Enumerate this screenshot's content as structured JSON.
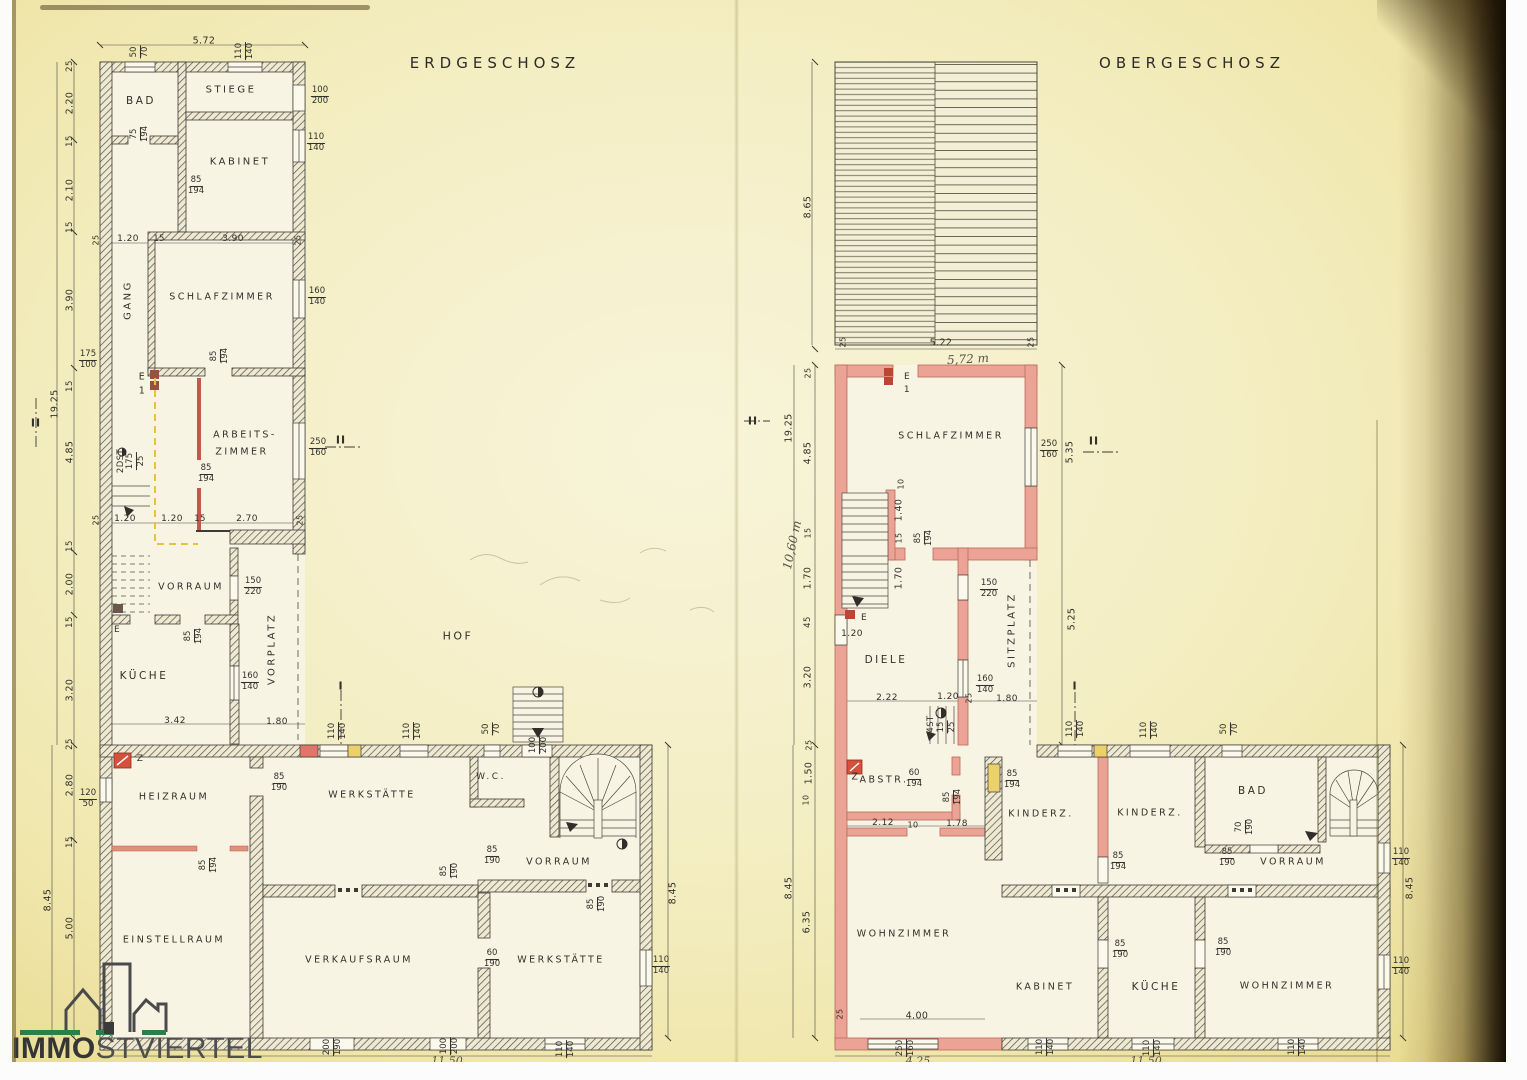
{
  "logo": {
    "bold": "IMMO",
    "light": "STVIERTEL"
  },
  "floors": {
    "left_title": "ERDGESCHOSZ",
    "right_title": "OBERGESCHOSZ"
  },
  "labels": [
    {
      "k": "title",
      "t": "ERDGESCHOSZ",
      "x": 495,
      "y": 63
    },
    {
      "k": "title",
      "t": "OBERGESCHOSZ",
      "x": 1192,
      "y": 63
    },
    {
      "k": "frac",
      "t": "50/70",
      "x": 140,
      "y": 52,
      "r": -90
    },
    {
      "k": "dim",
      "t": "5.72",
      "x": 204,
      "y": 41
    },
    {
      "k": "frac",
      "t": "110/140",
      "x": 245,
      "y": 51,
      "r": -90
    },
    {
      "k": "dim",
      "t": "25",
      "x": 70,
      "y": 66,
      "r": -90,
      "s": 8.5
    },
    {
      "k": "dim",
      "t": "2.20",
      "x": 70,
      "y": 103,
      "r": -90
    },
    {
      "k": "dim",
      "t": "15",
      "x": 70,
      "y": 141,
      "r": -90,
      "s": 8.5
    },
    {
      "k": "dim",
      "t": "2.10",
      "x": 70,
      "y": 190,
      "r": -90
    },
    {
      "k": "dim",
      "t": "15",
      "x": 70,
      "y": 227,
      "r": -90,
      "s": 8.5
    },
    {
      "k": "dim",
      "t": "3.90",
      "x": 70,
      "y": 300,
      "r": -90
    },
    {
      "k": "frac",
      "t": "175/100",
      "x": 88,
      "y": 360
    },
    {
      "k": "dim",
      "t": "15",
      "x": 70,
      "y": 386,
      "r": -90,
      "s": 8.5
    },
    {
      "k": "dim",
      "t": "19.25",
      "x": 55,
      "y": 404,
      "r": -90
    },
    {
      "k": "mark",
      "t": "II",
      "x": 36,
      "y": 423
    },
    {
      "k": "dim",
      "t": "4.85",
      "x": 70,
      "y": 452,
      "r": -90
    },
    {
      "k": "dim",
      "t": "15",
      "x": 70,
      "y": 546,
      "r": -90,
      "s": 8.5
    },
    {
      "k": "dim",
      "t": "2.00",
      "x": 70,
      "y": 584,
      "r": -90
    },
    {
      "k": "dim",
      "t": "15",
      "x": 70,
      "y": 622,
      "r": -90,
      "s": 8.5
    },
    {
      "k": "dim",
      "t": "3.20",
      "x": 70,
      "y": 690,
      "r": -90
    },
    {
      "k": "dim",
      "t": "25",
      "x": 70,
      "y": 744,
      "r": -90,
      "s": 8.5
    },
    {
      "k": "dim",
      "t": "2.80",
      "x": 70,
      "y": 785,
      "r": -90
    },
    {
      "k": "frac",
      "t": "120/50",
      "x": 88,
      "y": 799
    },
    {
      "k": "dim",
      "t": "15",
      "x": 70,
      "y": 842,
      "r": -90,
      "s": 8.5
    },
    {
      "k": "dim",
      "t": "8.45",
      "x": 48,
      "y": 900,
      "r": -90
    },
    {
      "k": "dim",
      "t": "5.00",
      "x": 70,
      "y": 928,
      "r": -90
    },
    {
      "k": "room",
      "t": "BAD",
      "x": 141,
      "y": 101,
      "s": 10.5
    },
    {
      "k": "room",
      "t": "STIEGE",
      "x": 231,
      "y": 90,
      "s": 10
    },
    {
      "k": "frac",
      "t": "100/200",
      "x": 320,
      "y": 96
    },
    {
      "k": "room",
      "t": "KABINET",
      "x": 240,
      "y": 162,
      "s": 10
    },
    {
      "k": "frac",
      "t": "110/140",
      "x": 316,
      "y": 143
    },
    {
      "k": "frac",
      "t": "75/194",
      "x": 140,
      "y": 134,
      "r": -90
    },
    {
      "k": "frac",
      "t": "85/194",
      "x": 196,
      "y": 186
    },
    {
      "k": "dim",
      "t": "25",
      "x": 96,
      "y": 240,
      "r": -90,
      "s": 8
    },
    {
      "k": "dim",
      "t": "1.20",
      "x": 128,
      "y": 239,
      "s": 9
    },
    {
      "k": "dim",
      "t": "15",
      "x": 159,
      "y": 239,
      "s": 8.5
    },
    {
      "k": "dim",
      "t": "3.90",
      "x": 233,
      "y": 239,
      "s": 9
    },
    {
      "k": "dim",
      "t": "25",
      "x": 298,
      "y": 240,
      "r": -90,
      "s": 8
    },
    {
      "k": "room",
      "t": "GANG",
      "x": 128,
      "y": 300,
      "r": -90,
      "s": 10
    },
    {
      "k": "room",
      "t": "SCHLAFZIMMER",
      "x": 222,
      "y": 297,
      "s": 9.5
    },
    {
      "k": "frac",
      "t": "160/140",
      "x": 317,
      "y": 297
    },
    {
      "k": "frac",
      "t": "85/194",
      "x": 220,
      "y": 356,
      "r": -90
    },
    {
      "k": "dim",
      "t": "E",
      "x": 142,
      "y": 377,
      "s": 9.5
    },
    {
      "k": "dim",
      "t": "1",
      "x": 142,
      "y": 391,
      "s": 9.5
    },
    {
      "k": "dim",
      "t": "2DST",
      "x": 121,
      "y": 461,
      "r": -90,
      "s": 8.5
    },
    {
      "k": "frac",
      "t": "175/25",
      "x": 136,
      "y": 461,
      "r": -90
    },
    {
      "k": "room",
      "t": "ARBEITS-",
      "x": 245,
      "y": 435,
      "s": 9.5
    },
    {
      "k": "room",
      "t": "ZIMMER",
      "x": 242,
      "y": 452,
      "s": 9.5
    },
    {
      "k": "frac",
      "t": "250/160",
      "x": 318,
      "y": 448
    },
    {
      "k": "mark",
      "t": "II",
      "x": 341,
      "y": 440
    },
    {
      "k": "frac",
      "t": "85/194",
      "x": 206,
      "y": 474
    },
    {
      "k": "dim",
      "t": "25",
      "x": 96,
      "y": 520,
      "r": -90,
      "s": 8
    },
    {
      "k": "dim",
      "t": "1.20",
      "x": 125,
      "y": 519,
      "s": 9
    },
    {
      "k": "dim",
      "t": "1.20",
      "x": 172,
      "y": 519,
      "s": 9
    },
    {
      "k": "dim",
      "t": "15",
      "x": 200,
      "y": 519,
      "s": 8.5
    },
    {
      "k": "dim",
      "t": "2.70",
      "x": 247,
      "y": 519,
      "s": 9
    },
    {
      "k": "dim",
      "t": "25",
      "x": 300,
      "y": 520,
      "r": -90,
      "s": 8
    },
    {
      "k": "room",
      "t": "VORRAUM",
      "x": 191,
      "y": 587,
      "s": 9.5
    },
    {
      "k": "frac",
      "t": "150/220",
      "x": 253,
      "y": 587
    },
    {
      "k": "dim",
      "t": "E",
      "x": 117,
      "y": 630,
      "s": 9
    },
    {
      "k": "frac",
      "t": "85/194",
      "x": 194,
      "y": 636,
      "r": -90
    },
    {
      "k": "room",
      "t": "KÜCHE",
      "x": 144,
      "y": 676,
      "s": 10.5
    },
    {
      "k": "room",
      "t": "VORPLATZ",
      "x": 272,
      "y": 649,
      "r": -90,
      "s": 10
    },
    {
      "k": "frac",
      "t": "160/140",
      "x": 250,
      "y": 682
    },
    {
      "k": "dim",
      "t": "3.42",
      "x": 175,
      "y": 721,
      "s": 9
    },
    {
      "k": "dim",
      "t": "1.80",
      "x": 277,
      "y": 722,
      "s": 9
    },
    {
      "k": "room",
      "t": "HOF",
      "x": 458,
      "y": 636,
      "s": 11
    },
    {
      "k": "mark",
      "t": "I",
      "x": 341,
      "y": 686
    },
    {
      "k": "frac",
      "t": "110/140",
      "x": 338,
      "y": 731,
      "r": -90
    },
    {
      "k": "frac",
      "t": "110/140",
      "x": 413,
      "y": 731,
      "r": -90
    },
    {
      "k": "frac",
      "t": "50/70",
      "x": 492,
      "y": 729,
      "r": -90
    },
    {
      "k": "frac",
      "t": "100/200",
      "x": 539,
      "y": 745,
      "r": -90
    },
    {
      "k": "dim",
      "t": "Z",
      "x": 140,
      "y": 759,
      "s": 9
    },
    {
      "k": "room",
      "t": "HEIZRAUM",
      "x": 174,
      "y": 797,
      "s": 9.5
    },
    {
      "k": "frac",
      "t": "85/190",
      "x": 279,
      "y": 783
    },
    {
      "k": "room",
      "t": "WERKSTÄTTE",
      "x": 372,
      "y": 795,
      "s": 9.5
    },
    {
      "k": "frac",
      "t": "85/194",
      "x": 209,
      "y": 865,
      "r": -90
    },
    {
      "k": "room",
      "t": "W.C.",
      "x": 491,
      "y": 777,
      "s": 9
    },
    {
      "k": "frac",
      "t": "85/190",
      "x": 492,
      "y": 856
    },
    {
      "k": "frac",
      "t": "85/190",
      "x": 450,
      "y": 871,
      "r": -90
    },
    {
      "k": "room",
      "t": "VORRAUM",
      "x": 559,
      "y": 862,
      "s": 9.5
    },
    {
      "k": "frac",
      "t": "85/190",
      "x": 597,
      "y": 904,
      "r": -90
    },
    {
      "k": "room",
      "t": "EINSTELLRAUM",
      "x": 174,
      "y": 940,
      "s": 9.5
    },
    {
      "k": "room",
      "t": "VERKAUFSRAUM",
      "x": 359,
      "y": 960,
      "s": 9.5
    },
    {
      "k": "frac",
      "t": "60/190",
      "x": 492,
      "y": 959
    },
    {
      "k": "room",
      "t": "WERKSTÄTTE",
      "x": 561,
      "y": 960,
      "s": 9.5
    },
    {
      "k": "frac",
      "t": "110/140",
      "x": 661,
      "y": 966
    },
    {
      "k": "dim",
      "t": "8.45",
      "x": 673,
      "y": 893,
      "r": -90
    },
    {
      "k": "frac",
      "t": "200/190",
      "x": 333,
      "y": 1047,
      "r": -90
    },
    {
      "k": "frac",
      "t": "100/200",
      "x": 450,
      "y": 1046,
      "r": -90
    },
    {
      "k": "hand",
      "t": "11,50",
      "x": 447,
      "y": 1061,
      "s": 11
    },
    {
      "k": "frac",
      "t": "110/140",
      "x": 566,
      "y": 1049,
      "r": -90
    },
    {
      "k": "dim",
      "t": "8.65",
      "x": 808,
      "y": 207,
      "r": -90
    },
    {
      "k": "dim",
      "t": "25",
      "x": 843,
      "y": 342,
      "r": -90,
      "s": 8
    },
    {
      "k": "dim",
      "t": "5.22",
      "x": 941,
      "y": 343
    },
    {
      "k": "dim",
      "t": "25",
      "x": 1031,
      "y": 342,
      "r": -90,
      "s": 8
    },
    {
      "k": "hand",
      "t": "5,72 m",
      "x": 968,
      "y": 359,
      "s": 12,
      "r": -3
    },
    {
      "k": "dim",
      "t": "25",
      "x": 808,
      "y": 373,
      "r": -90,
      "s": 8
    },
    {
      "k": "dim",
      "t": "19.25",
      "x": 789,
      "y": 428,
      "r": -90
    },
    {
      "k": "mark",
      "t": "II",
      "x": 753,
      "y": 421
    },
    {
      "k": "dim",
      "t": "4.85",
      "x": 808,
      "y": 453,
      "r": -90
    },
    {
      "k": "hand",
      "t": "10,60 m",
      "x": 792,
      "y": 545,
      "r": -78,
      "s": 12
    },
    {
      "k": "dim",
      "t": "15",
      "x": 808,
      "y": 533,
      "r": -90,
      "s": 8
    },
    {
      "k": "dim",
      "t": "1.70",
      "x": 808,
      "y": 578,
      "r": -90
    },
    {
      "k": "dim",
      "t": "45",
      "x": 808,
      "y": 622,
      "r": -90,
      "s": 8.5
    },
    {
      "k": "dim",
      "t": "E",
      "x": 907,
      "y": 377,
      "s": 9
    },
    {
      "k": "dim",
      "t": "1",
      "x": 907,
      "y": 390,
      "s": 9
    },
    {
      "k": "room",
      "t": "SCHLAFZIMMER",
      "x": 951,
      "y": 436,
      "s": 9.5
    },
    {
      "k": "frac",
      "t": "250/160",
      "x": 1049,
      "y": 450
    },
    {
      "k": "dim",
      "t": "5.35",
      "x": 1070,
      "y": 452,
      "r": -90
    },
    {
      "k": "mark",
      "t": "II",
      "x": 1094,
      "y": 441
    },
    {
      "k": "dim",
      "t": "10",
      "x": 901,
      "y": 484,
      "r": -90,
      "s": 8
    },
    {
      "k": "dim",
      "t": "1.40",
      "x": 899,
      "y": 510,
      "r": -90
    },
    {
      "k": "dim",
      "t": "15",
      "x": 899,
      "y": 538,
      "r": -90,
      "s": 8
    },
    {
      "k": "frac",
      "t": "85/194",
      "x": 924,
      "y": 538,
      "r": -90
    },
    {
      "k": "dim",
      "t": "1.70",
      "x": 899,
      "y": 578,
      "r": -90
    },
    {
      "k": "dim",
      "t": "E",
      "x": 864,
      "y": 618,
      "s": 9
    },
    {
      "k": "dim",
      "t": "1.20",
      "x": 852,
      "y": 634,
      "s": 9
    },
    {
      "k": "frac",
      "t": "150/220",
      "x": 989,
      "y": 589
    },
    {
      "k": "room",
      "t": "SITZPLATZ",
      "x": 1012,
      "y": 630,
      "r": -90,
      "s": 10
    },
    {
      "k": "dim",
      "t": "5.25",
      "x": 1072,
      "y": 619,
      "r": -90
    },
    {
      "k": "room",
      "t": "DIELE",
      "x": 886,
      "y": 660,
      "s": 10.5
    },
    {
      "k": "dim",
      "t": "2.22",
      "x": 887,
      "y": 698,
      "s": 9
    },
    {
      "k": "dim",
      "t": "1.20",
      "x": 948,
      "y": 697,
      "s": 9
    },
    {
      "k": "dim",
      "t": "25",
      "x": 969,
      "y": 698,
      "r": -90,
      "s": 8
    },
    {
      "k": "dim",
      "t": "1.80",
      "x": 1007,
      "y": 699,
      "s": 9
    },
    {
      "k": "frac",
      "t": "160/140",
      "x": 985,
      "y": 685
    },
    {
      "k": "dim",
      "t": "4ST",
      "x": 931,
      "y": 724,
      "r": -90,
      "s": 8.5
    },
    {
      "k": "frac",
      "t": "15/25",
      "x": 947,
      "y": 727,
      "r": -90
    },
    {
      "k": "mark",
      "t": "I",
      "x": 1075,
      "y": 686
    },
    {
      "k": "dim",
      "t": "3.20",
      "x": 808,
      "y": 677,
      "r": -90
    },
    {
      "k": "dim",
      "t": "25",
      "x": 809,
      "y": 745,
      "r": -90,
      "s": 8
    },
    {
      "k": "dim",
      "t": "1.50",
      "x": 809,
      "y": 773,
      "r": -90
    },
    {
      "k": "dim",
      "t": "10",
      "x": 806,
      "y": 800,
      "r": -90,
      "s": 8
    },
    {
      "k": "dim",
      "t": "8.45",
      "x": 789,
      "y": 888,
      "r": -90
    },
    {
      "k": "dim",
      "t": "6.35",
      "x": 807,
      "y": 922,
      "r": -90
    },
    {
      "k": "dim",
      "t": "Z",
      "x": 855,
      "y": 777,
      "s": 9.5
    },
    {
      "k": "room",
      "t": "ABSTR.",
      "x": 884,
      "y": 780,
      "s": 9.5
    },
    {
      "k": "frac",
      "t": "60/194",
      "x": 914,
      "y": 779
    },
    {
      "k": "frac",
      "t": "85/194",
      "x": 953,
      "y": 797,
      "r": -90
    },
    {
      "k": "dim",
      "t": "2.12",
      "x": 883,
      "y": 823,
      "s": 9
    },
    {
      "k": "dim",
      "t": "10",
      "x": 913,
      "y": 825,
      "s": 8
    },
    {
      "k": "dim",
      "t": "1.78",
      "x": 957,
      "y": 824,
      "s": 9
    },
    {
      "k": "frac",
      "t": "85/194",
      "x": 1012,
      "y": 780
    },
    {
      "k": "frac",
      "t": "110/140",
      "x": 1076,
      "y": 729,
      "r": -90
    },
    {
      "k": "frac",
      "t": "110/140",
      "x": 1150,
      "y": 730,
      "r": -90
    },
    {
      "k": "frac",
      "t": "50/70",
      "x": 1230,
      "y": 729,
      "r": -90
    },
    {
      "k": "room",
      "t": "KINDERZ.",
      "x": 1041,
      "y": 814,
      "s": 9.5
    },
    {
      "k": "room",
      "t": "KINDERZ.",
      "x": 1150,
      "y": 813,
      "s": 9.5
    },
    {
      "k": "frac",
      "t": "85/194",
      "x": 1118,
      "y": 862
    },
    {
      "k": "room",
      "t": "BAD",
      "x": 1253,
      "y": 791,
      "s": 10.5
    },
    {
      "k": "frac",
      "t": "70/190",
      "x": 1245,
      "y": 827,
      "r": -90
    },
    {
      "k": "frac",
      "t": "85/190",
      "x": 1227,
      "y": 858
    },
    {
      "k": "room",
      "t": "VORRAUM",
      "x": 1293,
      "y": 862,
      "s": 9.5
    },
    {
      "k": "frac",
      "t": "110/140",
      "x": 1401,
      "y": 858
    },
    {
      "k": "dim",
      "t": "8.45",
      "x": 1410,
      "y": 888,
      "r": -90
    },
    {
      "k": "frac",
      "t": "85/190",
      "x": 1223,
      "y": 948
    },
    {
      "k": "room",
      "t": "WOHNZIMMER",
      "x": 904,
      "y": 934,
      "s": 9.5
    },
    {
      "k": "dim",
      "t": "4.00",
      "x": 917,
      "y": 1016,
      "s": 9.5
    },
    {
      "k": "dim",
      "t": "25",
      "x": 840,
      "y": 1014,
      "r": -90,
      "s": 8
    },
    {
      "k": "room",
      "t": "KABINET",
      "x": 1045,
      "y": 987,
      "s": 9.5
    },
    {
      "k": "frac",
      "t": "85/190",
      "x": 1120,
      "y": 950
    },
    {
      "k": "room",
      "t": "KÜCHE",
      "x": 1156,
      "y": 987,
      "s": 10.5
    },
    {
      "k": "room",
      "t": "WOHNZIMMER",
      "x": 1287,
      "y": 986,
      "s": 9.5
    },
    {
      "k": "frac",
      "t": "110/140",
      "x": 1401,
      "y": 967
    },
    {
      "k": "frac",
      "t": "250/160",
      "x": 906,
      "y": 1048,
      "r": -90
    },
    {
      "k": "hand",
      "t": "4,25",
      "x": 918,
      "y": 1061,
      "s": 11
    },
    {
      "k": "frac",
      "t": "110/140",
      "x": 1046,
      "y": 1047,
      "r": -90
    },
    {
      "k": "frac",
      "t": "110/140",
      "x": 1153,
      "y": 1048,
      "r": -90
    },
    {
      "k": "hand",
      "t": "11,50",
      "x": 1146,
      "y": 1061,
      "s": 11
    },
    {
      "k": "frac",
      "t": "110/140",
      "x": 1298,
      "y": 1047,
      "r": -90
    }
  ]
}
